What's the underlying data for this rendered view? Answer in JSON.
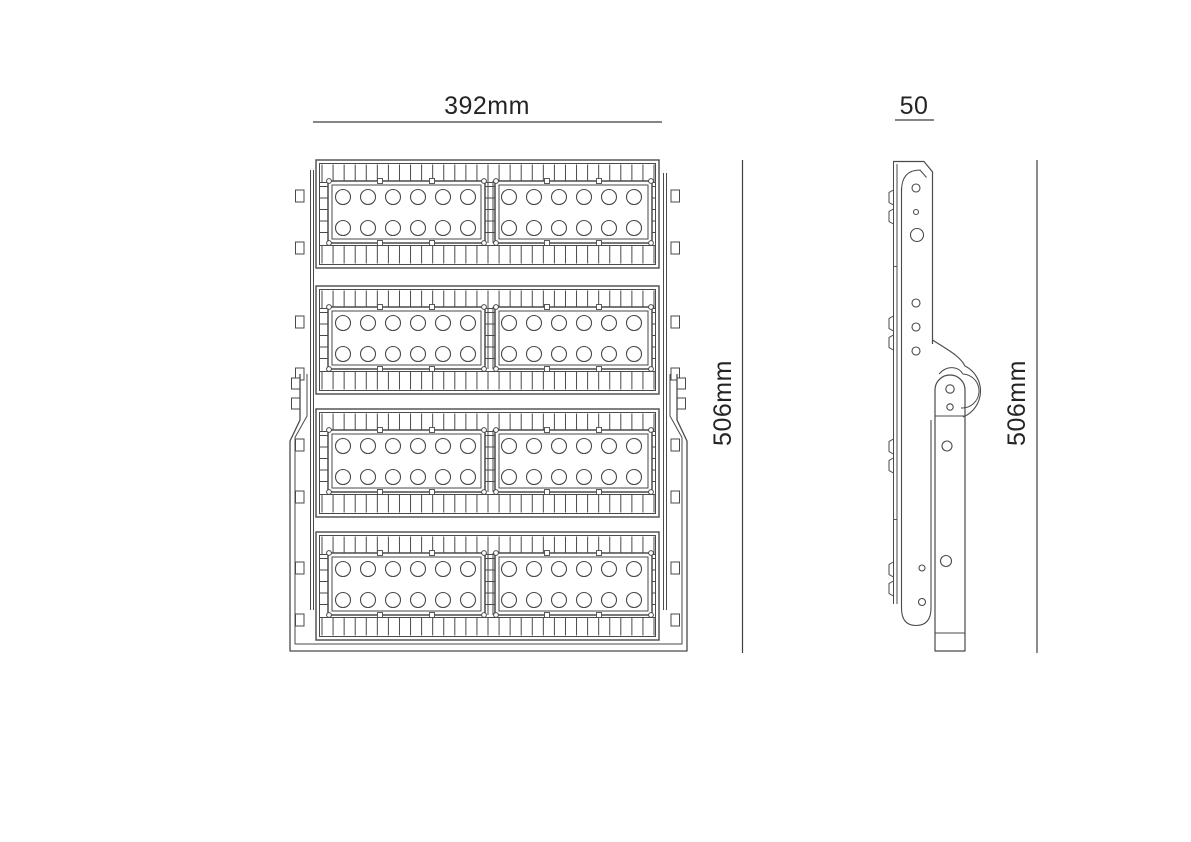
{
  "page": {
    "background": "#ffffff",
    "line_color": "#4a4a4a",
    "dim_line_color": "#3f3f3f",
    "text_color": "#262323"
  },
  "views": {
    "front": {
      "title": "front-view-technical-drawing",
      "width_dim_label": "392mm",
      "height_dim_label": "506mm",
      "module_rows": 4,
      "panels_per_row": 2,
      "led_columns_per_panel": 6,
      "led_rows_per_panel": 2
    },
    "side": {
      "title": "side-view-technical-drawing",
      "width_dim_label": "50",
      "height_dim_label": "506mm"
    }
  }
}
